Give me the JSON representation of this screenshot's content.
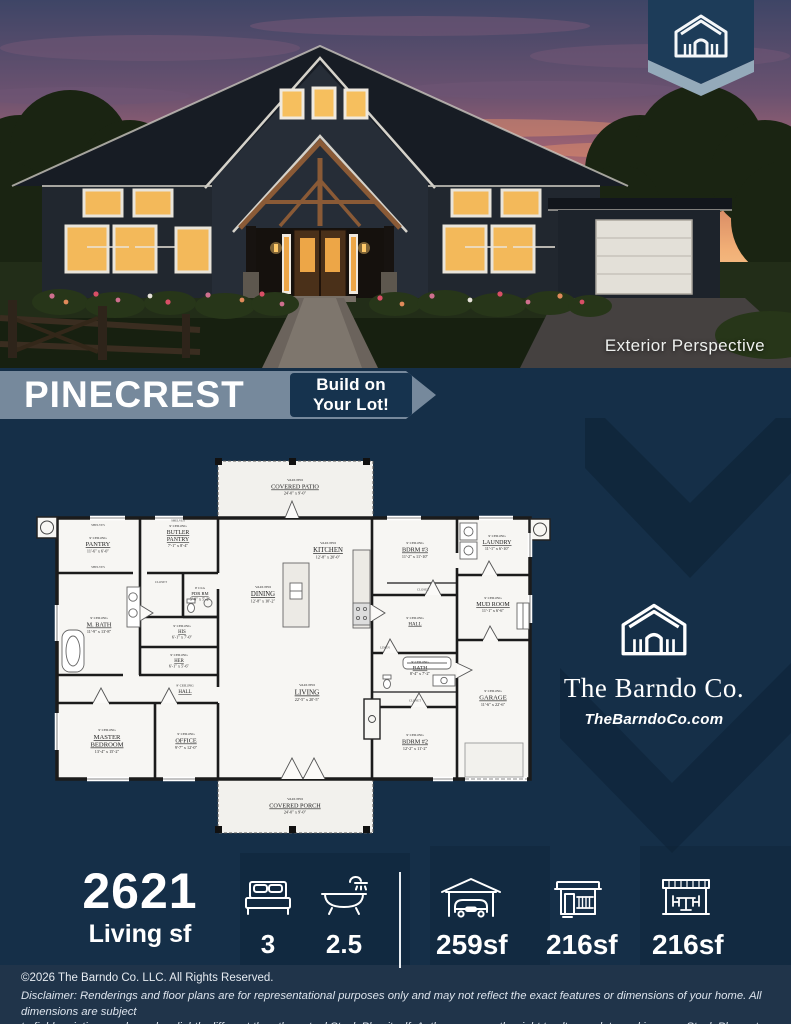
{
  "hero": {
    "caption": "Exterior Perspective"
  },
  "banner": {
    "plan_name": "PINECREST",
    "tagline": {
      "line1": "Build on",
      "line2": "Your Lot!"
    }
  },
  "brand": {
    "name": "The Barndo Co.",
    "website": "TheBarndoCo.com"
  },
  "colors": {
    "navy_bg": "#152f48",
    "band_slate": "#76899c",
    "tag_navy": "#16334e",
    "badge_navy": "#1d3c59",
    "badge_chevron": "#94aaba",
    "footer_bg": "#20344a",
    "plan_paper": "#f7f6f3",
    "window_glow": "#f3b95a"
  },
  "plan": {
    "rooms": [
      {
        "clg": "9' CEILING",
        "name": "PANTRY",
        "dims": "11'-6\" x 6'-0\""
      },
      {
        "clg": "9' CEILING",
        "name": "BUTLER",
        "name2": "PANTRY",
        "dims": "7'-1\" x 8'-4\""
      },
      {
        "clg": "9' CLG",
        "name": "PDR RM",
        "dims": "5'-0\" x 5'-2\""
      },
      {
        "clg": "VAULTED",
        "name": "DINING",
        "dims": "12'-8\" x 10'-2\""
      },
      {
        "clg": "VAULTED",
        "name": "KITCHEN",
        "dims": "12'-8\" x 20'-0\""
      },
      {
        "clg": "9' CEILING",
        "name": "M. BATH",
        "dims": "11'-9\" x 13'-8\""
      },
      {
        "clg": "9' CEILING",
        "name": "HIS",
        "dims": "6'-1\" x 7'-0\""
      },
      {
        "clg": "9' CEILING",
        "name": "HER",
        "dims": "6'-1\" x 5'-6\""
      },
      {
        "clg": "9' CEILING",
        "name": "HALL"
      },
      {
        "clg": "9' CEILING",
        "name": "MASTER",
        "name2": "BEDROOM",
        "dims": "13'-4\" x 15'-2\""
      },
      {
        "clg": "9' CEILING",
        "name": "OFFICE",
        "dims": "9'-7\" x 12'-0\""
      },
      {
        "clg": "VAULTED",
        "name": "LIVING",
        "dims": "22'-5\" x 20'-5\""
      },
      {
        "clg": "9' CEILING",
        "name": "BDRM #3",
        "dims": "11'-2\" x 11'-10\""
      },
      {
        "clg": "9' CEILING",
        "name": "HALL"
      },
      {
        "clg": "9' CEILING",
        "name": "BATH",
        "dims": "8'-4\" x 7'-2\""
      },
      {
        "clg": "9' CEILING",
        "name": "BDRM #2",
        "dims": "12'-2\" x 11'-2\""
      },
      {
        "clg": "9' CEILING",
        "name": "LAUNDRY",
        "dims": "11'-1\" x 6'-10\""
      },
      {
        "clg": "9' CEILING",
        "name": "MUD ROOM",
        "dims": "11'-1\" x 6'-6\""
      },
      {
        "clg": "9' CEILING",
        "name": "GARAGE",
        "dims": "11'-6\" x 22'-6\""
      },
      {
        "clg": "VAULTED",
        "name": "COVERED PATIO",
        "dims": "24'-0\" x 9'-0\""
      },
      {
        "clg": "VAULTED",
        "name": "COVERED PORCH",
        "dims": "24'-0\" x 9'-0\""
      }
    ],
    "notes": {
      "shelves": "SHELVES",
      "closet": "CLOSET",
      "linen": "LINEN"
    }
  },
  "stats": {
    "living_value": "2621",
    "living_label": "Living sf",
    "beds": "3",
    "baths": "2.5",
    "garage": "259sf",
    "porch": "216sf",
    "patio": "216sf"
  },
  "footer": {
    "copyright": "©2026 The Barndo Co. LLC. All Rights Reserved.",
    "disclaimer_1": "Disclaimer: Renderings and floor plans are for representational purposes only and may not reflect the exact features or dimensions of your home. All dimensions are subject",
    "disclaimer_2": "to field variations and may be slightly different than the actual Stock Plan itself. Author reserves the right to alter, update and improve Stock Plans at their discretion."
  }
}
